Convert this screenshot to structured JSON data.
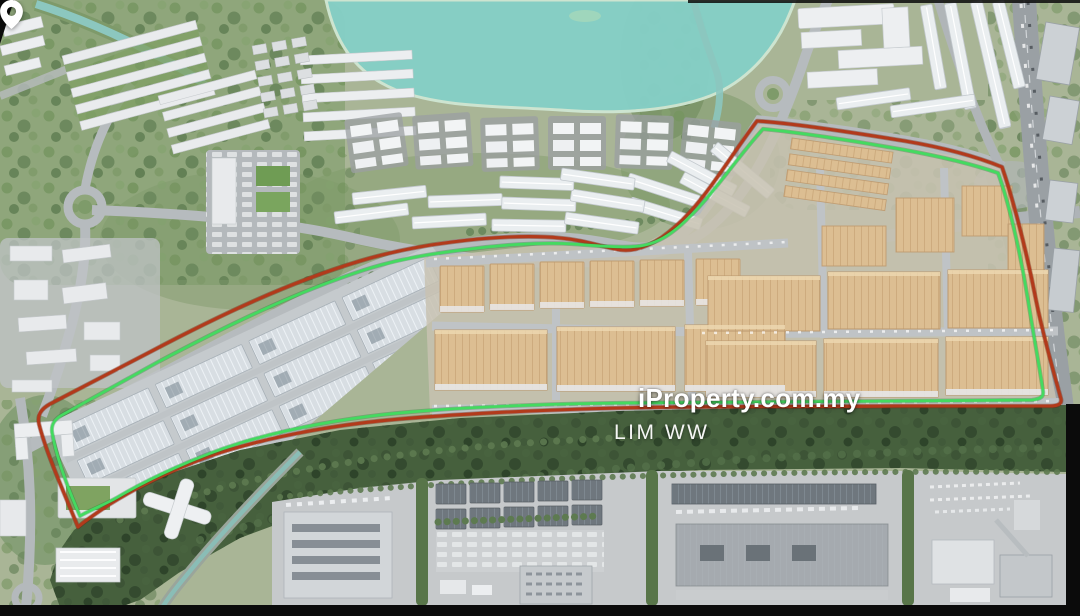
{
  "watermark": {
    "brand": "iProperty.com.my",
    "agent_name": "LIM WW",
    "pin_icon": "location-pin-icon",
    "text_color": "#ffffff"
  },
  "scene": {
    "type": "aerial-3d-masterplan-render",
    "water_color": "#85cfc6",
    "forest_color": "#46603d",
    "industrial_roof_beige": "#dcbe92",
    "industrial_roof_gray": "#d8dee3",
    "letterbox_color": "#0b0b0b",
    "features": [
      "lake",
      "river",
      "canal",
      "roundabouts",
      "residential-clusters",
      "terraced-house-arcs",
      "apartment-blocks",
      "beige-industrial-park",
      "gray-warehouse-estate",
      "forest-buffer",
      "factory-zone",
      "highway"
    ]
  },
  "boundaries": {
    "outer": {
      "name": "site-boundary-outer",
      "color": "#b23a1b"
    },
    "inner": {
      "name": "site-boundary-inner",
      "color": "#44da60"
    }
  }
}
